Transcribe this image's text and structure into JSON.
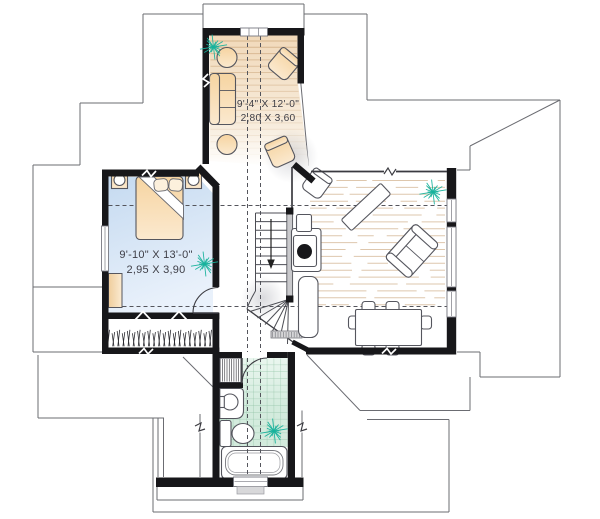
{
  "plan": {
    "labels": {
      "sitting": {
        "imperial": "9'-4\" X 12'-0\"",
        "metric": "2,80 X 3,60"
      },
      "bedroom": {
        "imperial": "9'-10\" X 13'-0\"",
        "metric": "2,95 X 3,90"
      }
    },
    "icons": {
      "plant": "plant-starburst-icon",
      "stair_direction": "down-arrow-icon"
    },
    "colors": {
      "wall": "#17171a",
      "line": "#54555c",
      "roof": "#6b6c72",
      "sitting_floor": "#f1d9ba",
      "bedroom_floor": "#c5daf0",
      "bedroom_floor_light": "#e9f1fb",
      "bath_floor": "#d3ebdd",
      "bath_floor_light": "#eaf6ef",
      "tile_line": "#94c5a8",
      "plank_line": "#c49a6b",
      "furniture_beige": "#f6d4a1",
      "furniture_beige_light": "#fbe9cf",
      "furniture_line": "#55565e",
      "plant": "#17b29c",
      "text": "#3e3e46",
      "railing": "#c9c9cc",
      "landing": "#d6d6d8",
      "window_frame": "#777880",
      "sill": "#d8d8da"
    }
  }
}
